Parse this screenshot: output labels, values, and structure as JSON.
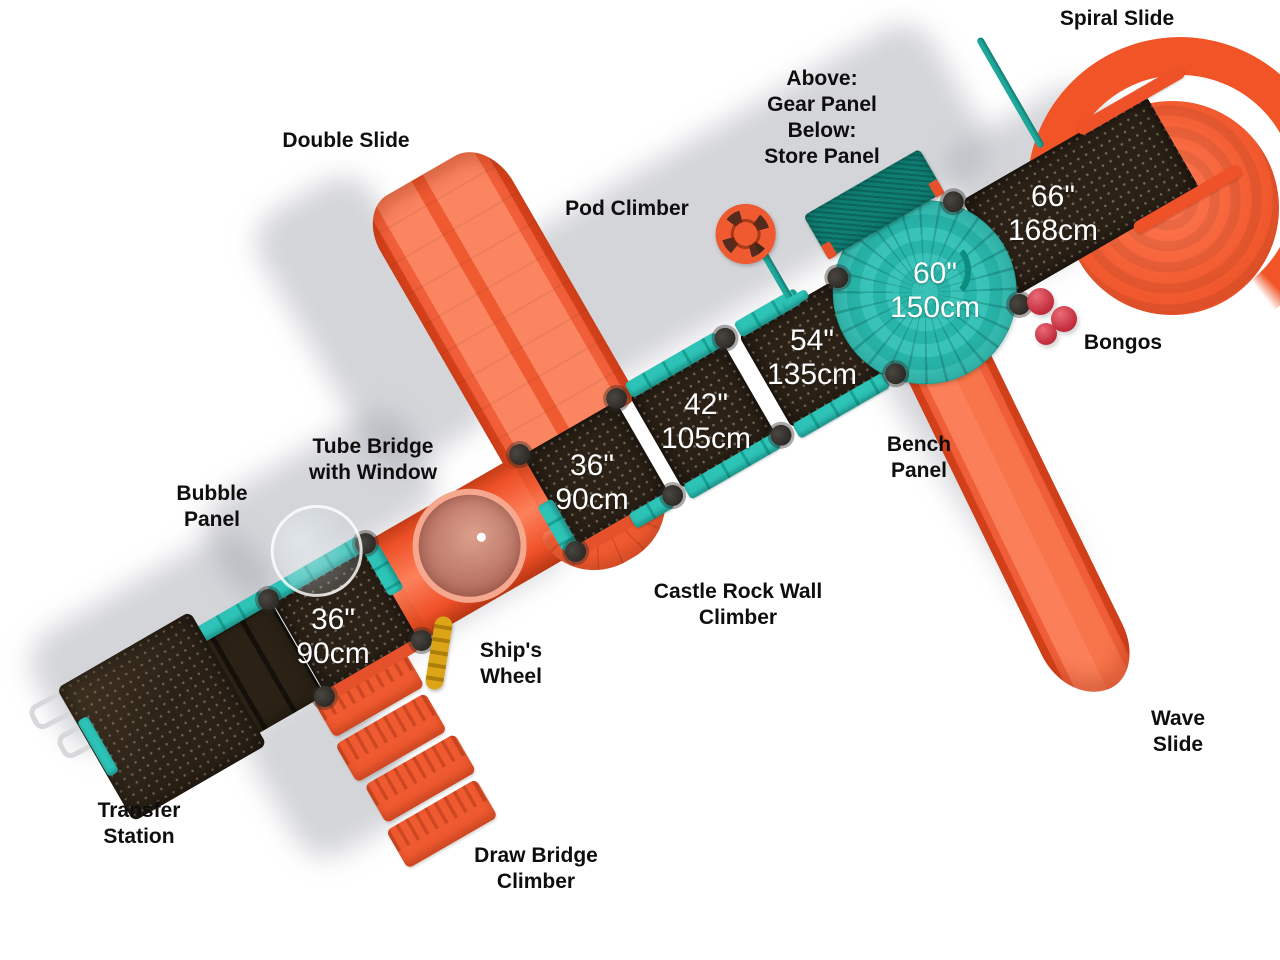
{
  "colors": {
    "slide_orange": "#f15527",
    "rail_teal": "#2dc3b7",
    "panel_dark_teal": "#0f7e73",
    "deck_brown": "#2b2116",
    "bongo_red": "#c42f3e",
    "wheel_yellow": "#dba517",
    "label_black": "#0e0e0e",
    "dim_white": "#ffffff",
    "background": "#ffffff"
  },
  "labels": {
    "spiral_slide": "Spiral Slide",
    "double_slide": "Double Slide",
    "panel_stack": "Above:\nGear Panel\nBelow:\nStore Panel",
    "pod_climber": "Pod Climber",
    "bongos": "Bongos",
    "tube_bridge": "Tube Bridge\nwith Window",
    "bubble_panel": "Bubble\nPanel",
    "bench_panel": "Bench\nPanel",
    "castle_rock": "Castle Rock Wall\nClimber",
    "ships_wheel": "Ship's\nWheel",
    "wave_slide": "Wave Slide",
    "transfer_station": "Transfer\nStation",
    "draw_bridge": "Draw Bridge\nClimber"
  },
  "decks": {
    "deck_36_lower": {
      "inches": "36\"",
      "cm": "90cm"
    },
    "deck_36_upper": {
      "inches": "36\"",
      "cm": "90cm"
    },
    "deck_42": {
      "inches": "42\"",
      "cm": "105cm"
    },
    "deck_54": {
      "inches": "54\"",
      "cm": "135cm"
    },
    "deck_60": {
      "inches": "60\"",
      "cm": "150cm"
    },
    "deck_66": {
      "inches": "66\"",
      "cm": "168cm"
    }
  }
}
